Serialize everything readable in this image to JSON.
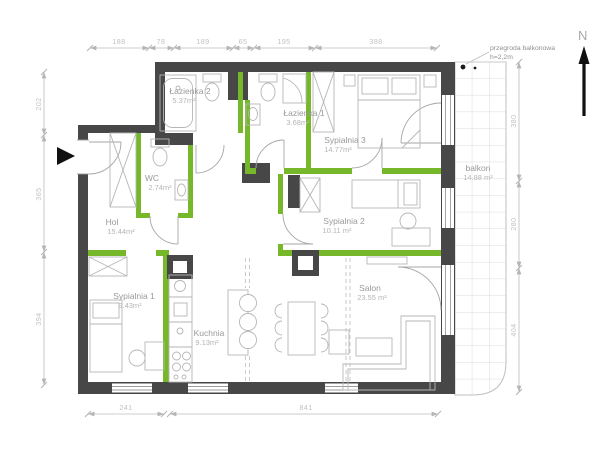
{
  "north": {
    "label": "N"
  },
  "annotation": {
    "line1": "przegroda balkonowa",
    "line2": "h=2,2m"
  },
  "rooms": {
    "lazienka2": {
      "name": "Łazienka 2",
      "area": "5.37m²"
    },
    "lazienka1": {
      "name": "Łazienka 1",
      "area": "3.68m²"
    },
    "wc": {
      "name": "WC",
      "area": "2.74m²"
    },
    "hol": {
      "name": "Hol",
      "area": "15.44m²"
    },
    "sypialnia3": {
      "name": "Sypialnia 3",
      "area": "14.77m²"
    },
    "sypialnia2": {
      "name": "Sypialnia 2",
      "area": "10.11 m²"
    },
    "sypialnia1": {
      "name": "Sypialnia 1",
      "area": "9.43m²"
    },
    "kuchnia": {
      "name": "Kuchnia",
      "area": "9.13m²"
    },
    "salon": {
      "name": "Salon",
      "area": "23.55 m²"
    },
    "balkon": {
      "name": "balkon",
      "area": "14.88 m²"
    }
  },
  "dimensions": {
    "top": [
      "188",
      "78",
      "189",
      "65",
      "195",
      "388"
    ],
    "left": [
      "202",
      "365",
      "394"
    ],
    "right": [
      "380",
      "280",
      "404"
    ],
    "bottom": [
      "241",
      "841"
    ]
  },
  "colors": {
    "outer_wall": "#474747",
    "partition_wall": "#76b82a",
    "furniture_line": "#b6b6b6",
    "dimension_text": "#c2c2c2",
    "room_text": "#999999"
  }
}
